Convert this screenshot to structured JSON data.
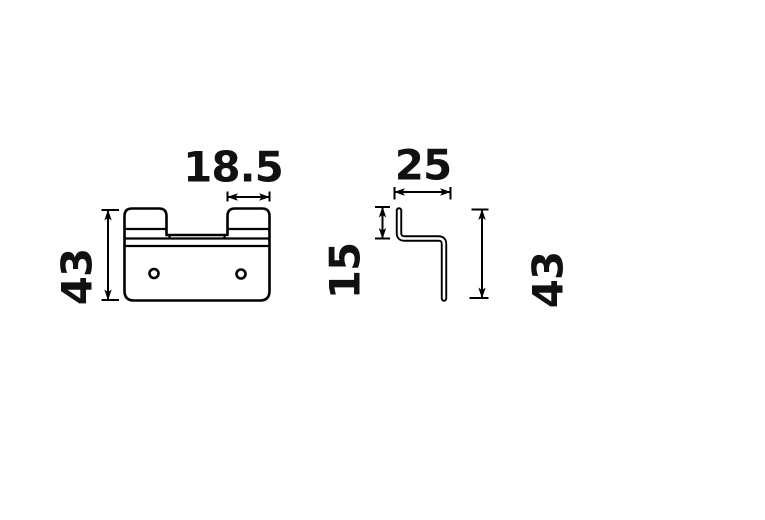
{
  "canvas": {
    "background": "#ffffff",
    "line_color": "#000000",
    "text_color": "#111111"
  },
  "drawing": {
    "description": "Two-view technical dimension drawing of a hook bracket",
    "front_view": {
      "name": "front view",
      "hole_count": 2
    },
    "side_view": {
      "name": "side profile view"
    },
    "dimensions": [
      {
        "id": "front-tab-width",
        "label": "18.5",
        "orientation": "horizontal"
      },
      {
        "id": "front-overall-height",
        "label": "43",
        "orientation": "vertical"
      },
      {
        "id": "side-depth",
        "label": "25",
        "orientation": "horizontal"
      },
      {
        "id": "side-lip-height",
        "label": "15",
        "orientation": "vertical"
      },
      {
        "id": "side-overall-height",
        "label": "43",
        "orientation": "vertical"
      }
    ]
  }
}
